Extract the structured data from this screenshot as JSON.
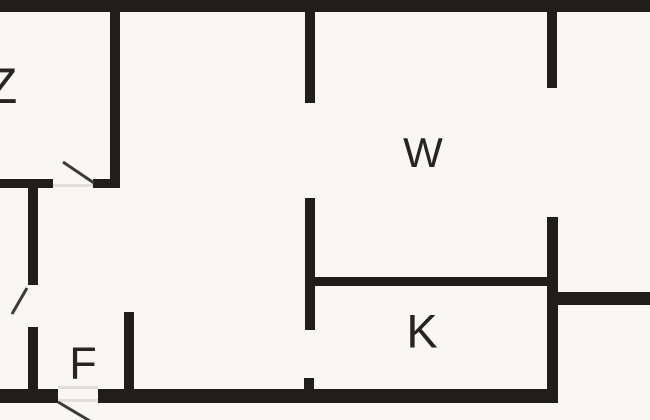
{
  "meta": {
    "type": "floor-plan",
    "width_px": 650,
    "height_px": 420
  },
  "colors": {
    "background": "#f8f7f2",
    "wall": "#201e1b",
    "door_line": "#3d3b38",
    "threshold": "#e2dfd7",
    "label": "#262522"
  },
  "rooms": [
    {
      "id": "z",
      "label": "Z",
      "cx": 2,
      "cy": 86,
      "font_px": 50
    },
    {
      "id": "w",
      "label": "W",
      "cx": 423,
      "cy": 153,
      "font_px": 42
    },
    {
      "id": "k",
      "label": "K",
      "cx": 422,
      "cy": 331,
      "font_px": 47
    },
    {
      "id": "f",
      "label": "F",
      "cx": 83,
      "cy": 363,
      "font_px": 45
    }
  ],
  "walls": [
    {
      "name": "outer-top-wall",
      "x": 0,
      "y": 0,
      "w": 650,
      "h": 12
    },
    {
      "name": "room-z-right-wall",
      "x": 110,
      "y": 12,
      "w": 10,
      "h": 175
    },
    {
      "name": "room-z-bottom-wall-left",
      "x": 0,
      "y": 179,
      "w": 53,
      "h": 9
    },
    {
      "name": "room-z-bottom-wall-right",
      "x": 93,
      "y": 179,
      "w": 27,
      "h": 9
    },
    {
      "name": "hall-left-wall-upper",
      "x": 28,
      "y": 188,
      "w": 10,
      "h": 97
    },
    {
      "name": "hall-left-wall-lower",
      "x": 28,
      "y": 327,
      "w": 10,
      "h": 62
    },
    {
      "name": "room-f-right-wall",
      "x": 124,
      "y": 312,
      "w": 10,
      "h": 77
    },
    {
      "name": "center-wall-upper",
      "x": 305,
      "y": 12,
      "w": 10,
      "h": 91
    },
    {
      "name": "center-wall-middle",
      "x": 305,
      "y": 198,
      "w": 10,
      "h": 132
    },
    {
      "name": "center-wall-stub",
      "x": 304,
      "y": 378,
      "w": 10,
      "h": 11
    },
    {
      "name": "room-k-top-wall",
      "x": 315,
      "y": 277,
      "w": 232,
      "h": 9
    },
    {
      "name": "right-wall-top-stub",
      "x": 547,
      "y": 12,
      "w": 10,
      "h": 76
    },
    {
      "name": "right-wall-main",
      "x": 547,
      "y": 217,
      "w": 11,
      "h": 186
    },
    {
      "name": "right-lower-wall",
      "x": 547,
      "y": 292,
      "w": 103,
      "h": 13
    },
    {
      "name": "outer-bottom-wall-left",
      "x": 0,
      "y": 389,
      "w": 58,
      "h": 14
    },
    {
      "name": "outer-bottom-wall-main",
      "x": 98,
      "y": 389,
      "w": 460,
      "h": 14
    }
  ],
  "doors": [
    {
      "name": "room-z-door-swing",
      "x1": 63,
      "y1": 162,
      "x2": 94,
      "y2": 183
    },
    {
      "name": "side-room-door-swing",
      "x1": 27,
      "y1": 288,
      "x2": 12,
      "y2": 314
    },
    {
      "name": "entry-door-swing",
      "x1": 58,
      "y1": 402,
      "x2": 90,
      "y2": 421
    }
  ],
  "thresholds": [
    {
      "name": "room-z-door-threshold",
      "x": 53,
      "y": 184,
      "w": 40,
      "h": 3
    },
    {
      "name": "entry-door-threshold-top",
      "x": 58,
      "y": 386,
      "w": 40,
      "h": 3
    },
    {
      "name": "entry-door-threshold-bottom",
      "x": 58,
      "y": 399,
      "w": 40,
      "h": 3
    }
  ]
}
